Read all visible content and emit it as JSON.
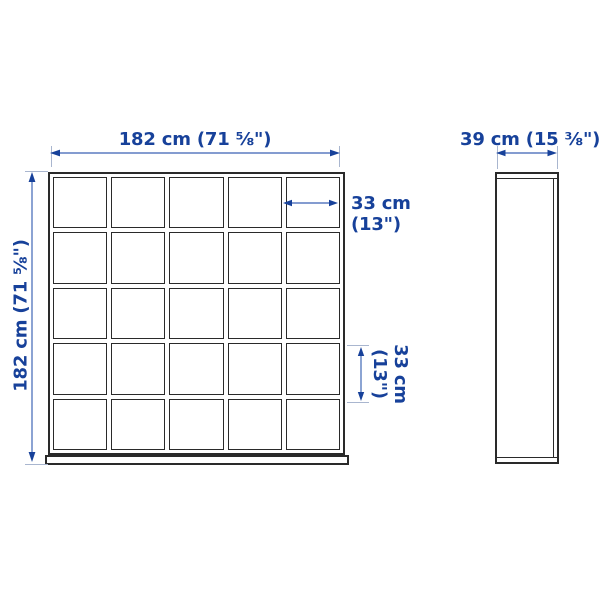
{
  "drawing": {
    "type": "product-dimension-diagram",
    "background": "#ffffff",
    "colors": {
      "dimension_text": "#17419a",
      "arrow_line": "#5b7cc0",
      "outline": "#2a2a2a",
      "extension_line": "#a9b6cf"
    },
    "front_view": {
      "grid": {
        "rows": 5,
        "columns": 5
      },
      "width_dimension": "182 cm (71 ⅝\")",
      "height_dimension": "182 cm (71 ⅝\")",
      "cell_width_dimension": {
        "line1": "33 cm",
        "line2": "(13\")"
      },
      "cell_height_dimension": {
        "line1": "33 cm",
        "line2": "(13\")"
      }
    },
    "side_view": {
      "depth_dimension": "39 cm (15 ⅜\")"
    }
  }
}
